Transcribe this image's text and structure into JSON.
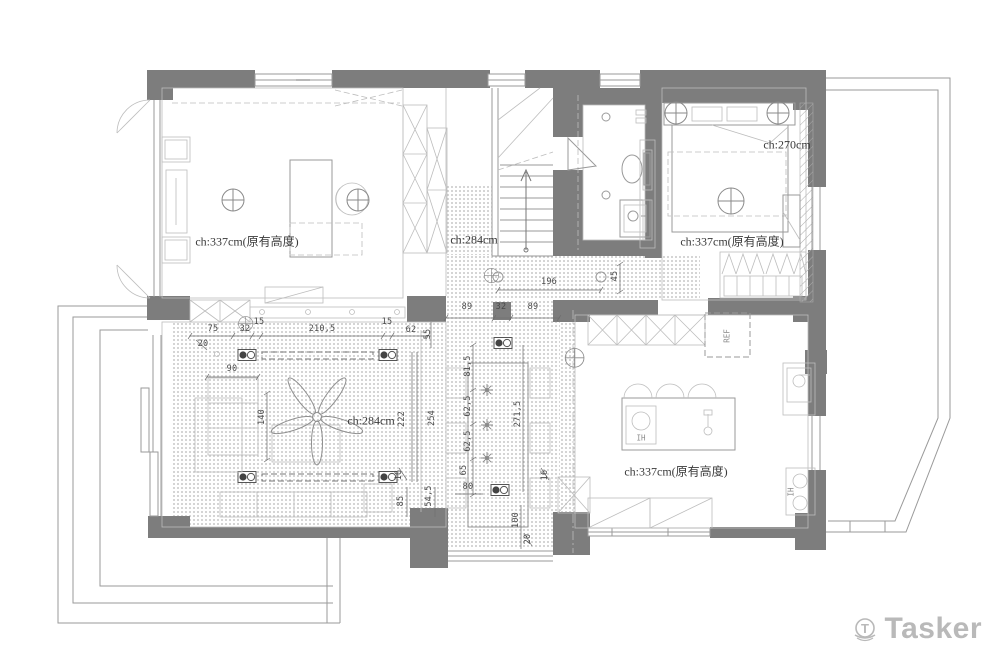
{
  "colors": {
    "wall": "#7d7d7d",
    "line": "#9a9a9a",
    "lite": "#bdbdbd",
    "dimline": "#6f6f6f",
    "dimtext": "#4a4a4a",
    "label": "#3a3a3a",
    "stipple": "#c7c7c7",
    "brand": "#b9b9b9"
  },
  "watermark": {
    "brand": "Tasker"
  },
  "room_labels": [
    {
      "t": "ch:337cm(原有高度)",
      "x": 247,
      "y": 241
    },
    {
      "t": "ch:284cm",
      "x": 474,
      "y": 240
    },
    {
      "t": "ch:284cm",
      "x": 371,
      "y": 421
    },
    {
      "t": "ch:270cm",
      "x": 787,
      "y": 145
    },
    {
      "t": "ch:337cm(原有高度)",
      "x": 732,
      "y": 241
    },
    {
      "t": "ch:337cm(原有高度)",
      "x": 676,
      "y": 471
    }
  ],
  "appliance_labels": [
    {
      "t": "REF",
      "x": 727,
      "y": 336,
      "r": 1
    },
    {
      "t": "IH",
      "x": 641,
      "y": 438
    },
    {
      "t": "IH",
      "x": 791,
      "y": 492,
      "r": 1
    }
  ],
  "dimensions": [
    {
      "t": "75",
      "x": 213,
      "y": 329
    },
    {
      "t": "32",
      "x": 245,
      "y": 329
    },
    {
      "t": "15",
      "x": 259,
      "y": 322
    },
    {
      "t": "210,5",
      "x": 322,
      "y": 329
    },
    {
      "t": "15",
      "x": 387,
      "y": 322
    },
    {
      "t": "62",
      "x": 411,
      "y": 330
    },
    {
      "t": "20",
      "x": 203,
      "y": 344
    },
    {
      "t": "55",
      "x": 428,
      "y": 334,
      "r": 1
    },
    {
      "t": "90",
      "x": 232,
      "y": 369
    },
    {
      "t": "140",
      "x": 262,
      "y": 417,
      "r": 1
    },
    {
      "t": "196",
      "x": 549,
      "y": 282
    },
    {
      "t": "45",
      "x": 615,
      "y": 276,
      "r": 1
    },
    {
      "t": "89",
      "x": 467,
      "y": 307
    },
    {
      "t": "32",
      "x": 501,
      "y": 307
    },
    {
      "t": "89",
      "x": 533,
      "y": 307
    },
    {
      "t": "81,5",
      "x": 468,
      "y": 366,
      "r": 1
    },
    {
      "t": "62,5",
      "x": 468,
      "y": 406,
      "r": 1
    },
    {
      "t": "62,5",
      "x": 468,
      "y": 441,
      "r": 1
    },
    {
      "t": "65",
      "x": 464,
      "y": 470,
      "r": 1
    },
    {
      "t": "271,5",
      "x": 518,
      "y": 414,
      "r": 1
    },
    {
      "t": "80",
      "x": 468,
      "y": 487
    },
    {
      "t": "16",
      "x": 545,
      "y": 475,
      "r": 1
    },
    {
      "t": "16",
      "x": 399,
      "y": 475,
      "r": 1
    },
    {
      "t": "85",
      "x": 401,
      "y": 501,
      "r": 1
    },
    {
      "t": "54,5",
      "x": 429,
      "y": 496,
      "r": 1
    },
    {
      "t": "222",
      "x": 402,
      "y": 419,
      "r": 1
    },
    {
      "t": "254",
      "x": 432,
      "y": 418,
      "r": 1
    },
    {
      "t": "100",
      "x": 516,
      "y": 520,
      "r": 1
    },
    {
      "t": "20",
      "x": 528,
      "y": 539,
      "r": 1
    }
  ]
}
